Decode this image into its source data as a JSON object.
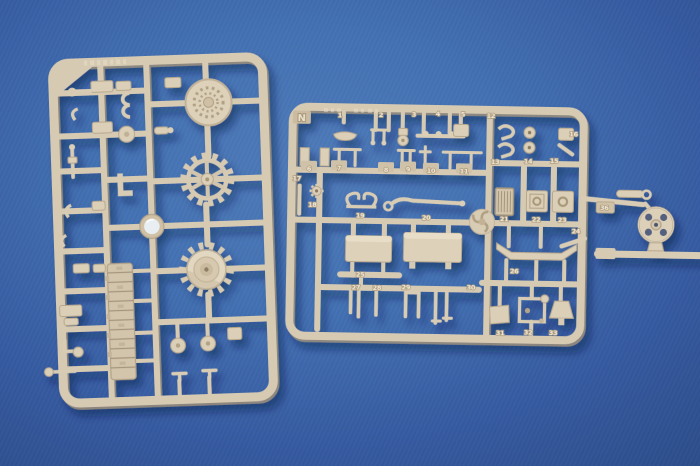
{
  "scene": {
    "type": "product-photo",
    "subject": "Two tan styrene model-kit sprues (injection-molded part frames with tank parts) photographed on a blue backdrop",
    "background": "seamless blue backdrop with corner vignette"
  },
  "palette": {
    "bg_center": "#4e7ab9",
    "bg_edge": "#2a4b85",
    "styrene": "#d7cab2",
    "styrene_light": "#efe5d1",
    "styrene_dark": "#a5957b",
    "cast_shadow": "#0a1a40",
    "clear_part": "#eaf2f8",
    "hole_dark": "#55617f"
  },
  "sprue_left": {
    "parts": [
      "perforated-roadwheel",
      "small-hub-cap",
      "sprocket-ring",
      "drive-sprocket-cone",
      "clear-lens",
      "track-link-strip",
      "small-road-wheels",
      "hooks-brackets-and-pins"
    ]
  },
  "sprue_right": {
    "letter": "N",
    "parts": [
      "stowage-dish",
      "u-bracket",
      "pulley",
      "tool-rod",
      "hook-pawls",
      "rollers",
      "periscope-blocks",
      "post-parts",
      "starburst-wheel",
      "scroll-bracket",
      "tow-rod",
      "three-blade-fan",
      "radiator-grille",
      "hatch-box",
      "hatch-box",
      "fuel-tank",
      "fuel-tank",
      "fender-beam",
      "pins",
      "fork",
      "plate",
      "frame-bracket",
      "lamp-cone",
      "idler-wheel"
    ],
    "labels": [
      {
        "t": "1",
        "x": 338,
        "y": 119
      },
      {
        "t": "2",
        "x": 379,
        "y": 118
      },
      {
        "t": "3",
        "x": 412,
        "y": 117
      },
      {
        "t": "4",
        "x": 436,
        "y": 116
      },
      {
        "t": "5",
        "x": 461,
        "y": 116
      },
      {
        "t": "12",
        "x": 489,
        "y": 117
      },
      {
        "t": "16",
        "x": 572,
        "y": 134
      },
      {
        "t": "13",
        "x": 494,
        "y": 163
      },
      {
        "t": "14",
        "x": 527,
        "y": 162
      },
      {
        "t": "15",
        "x": 553,
        "y": 161
      },
      {
        "t": "6",
        "x": 308,
        "y": 173
      },
      {
        "t": "7",
        "x": 338,
        "y": 172
      },
      {
        "t": "8",
        "x": 385,
        "y": 173
      },
      {
        "t": "9",
        "x": 407,
        "y": 172
      },
      {
        "t": "10",
        "x": 430,
        "y": 173
      },
      {
        "t": "11",
        "x": 463,
        "y": 173
      },
      {
        "t": "17",
        "x": 296,
        "y": 183
      },
      {
        "t": "18",
        "x": 312,
        "y": 209
      },
      {
        "t": "19",
        "x": 360,
        "y": 219
      },
      {
        "t": "20",
        "x": 426,
        "y": 220
      },
      {
        "t": "21",
        "x": 504,
        "y": 220
      },
      {
        "t": "22",
        "x": 536,
        "y": 220
      },
      {
        "t": "23",
        "x": 562,
        "y": 220
      },
      {
        "t": "24",
        "x": 576,
        "y": 231
      },
      {
        "t": "25",
        "x": 361,
        "y": 278
      },
      {
        "t": "26",
        "x": 515,
        "y": 272
      },
      {
        "t": "27",
        "x": 357,
        "y": 291
      },
      {
        "t": "28",
        "x": 378,
        "y": 291
      },
      {
        "t": "29",
        "x": 407,
        "y": 290
      },
      {
        "t": "30",
        "x": 472,
        "y": 289
      },
      {
        "t": "31",
        "x": 502,
        "y": 334
      },
      {
        "t": "32",
        "x": 530,
        "y": 333
      },
      {
        "t": "33",
        "x": 555,
        "y": 333
      },
      {
        "t": "36",
        "x": 604,
        "y": 207
      }
    ]
  }
}
